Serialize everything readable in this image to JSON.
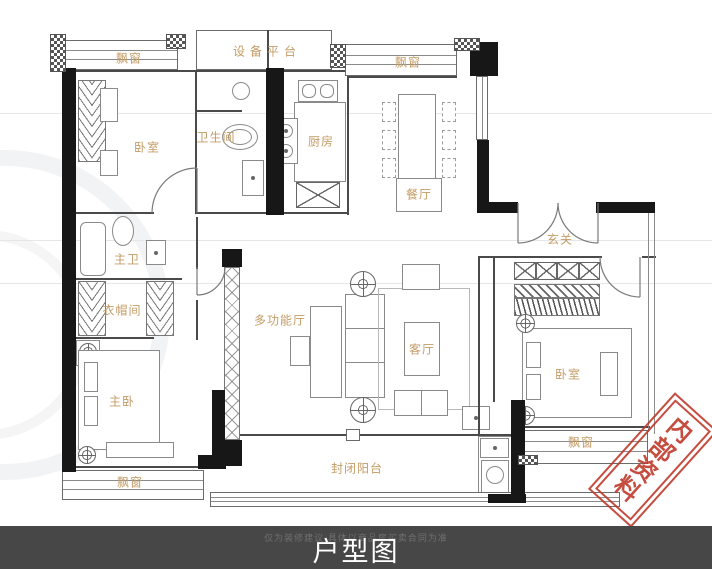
{
  "title_bar": {
    "title": "户型图",
    "disclaimer": "仅为装修建议 具体以商品房买卖合同为准"
  },
  "stamp": {
    "text": "内部资料"
  },
  "rooms": {
    "bay_window_top_left": "飘窗",
    "equipment_platform": "设备平台",
    "bay_window_top_right": "飘窗",
    "bedroom_top_left": "卧室",
    "bathroom": "卫生间",
    "kitchen": "厨房",
    "dining_room": "餐厅",
    "entry_hall": "玄关",
    "master_bathroom": "主卫",
    "cloakroom": "衣帽间",
    "multi_function_hall": "多功能厅",
    "living_room": "客厅",
    "master_bedroom": "主卧",
    "bedroom_right": "卧室",
    "bay_window_bottom_left": "飘窗",
    "bay_window_bottom_right": "飘窗",
    "enclosed_balcony": "封闭阳台"
  },
  "colors": {
    "room_label": "#c49c66",
    "wall": "#171717",
    "stamp_red": "#bf3a2b",
    "footer_bg": "#474747",
    "footer_text": "#ffffff"
  }
}
